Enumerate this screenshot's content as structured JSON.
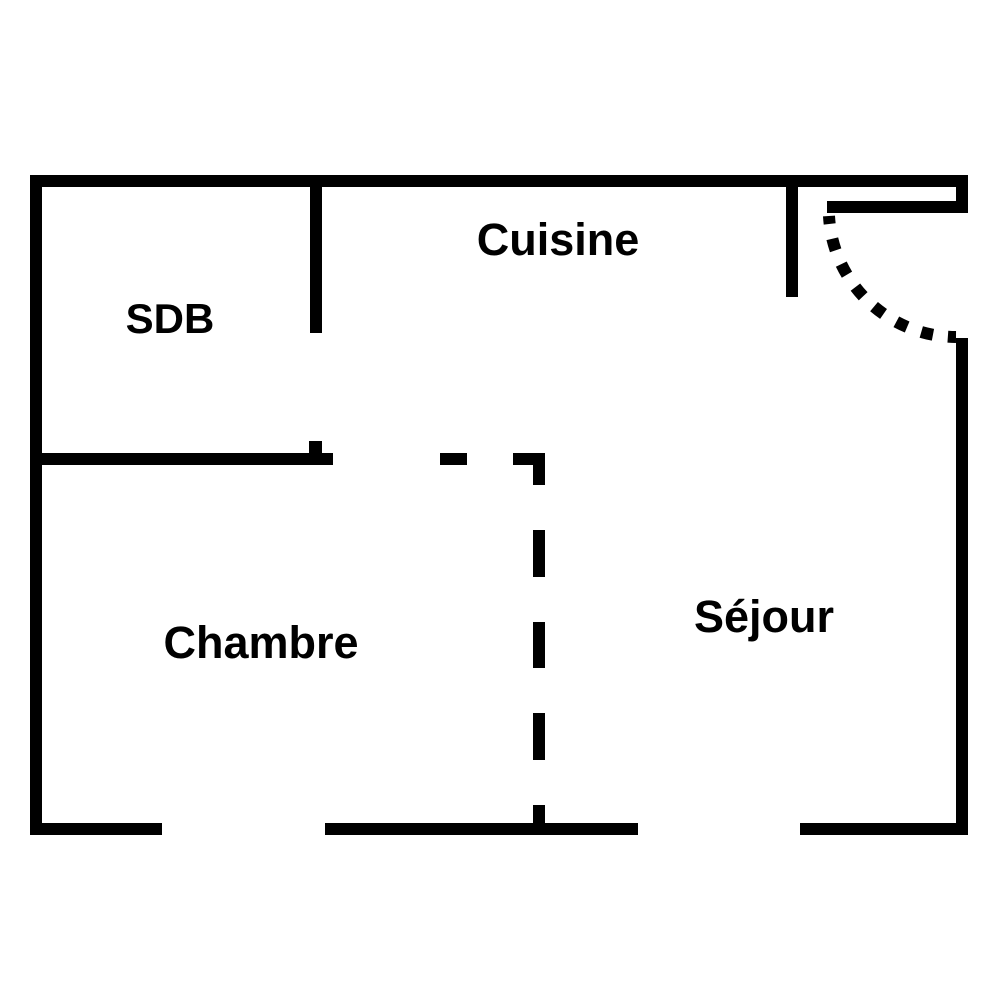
{
  "colors": {
    "walls": "#000000",
    "background": "#ffffff"
  },
  "floorplan": {
    "rooms": [
      {
        "id": "sdb",
        "label": "SDB"
      },
      {
        "id": "cuisine",
        "label": "Cuisine"
      },
      {
        "id": "chambre",
        "label": "Chambre"
      },
      {
        "id": "sejour",
        "label": "Séjour"
      }
    ],
    "features": [
      {
        "name": "entry-door-swing",
        "type": "dotted-arc"
      },
      {
        "name": "open-partition",
        "type": "dashed-line"
      },
      {
        "name": "door-openings",
        "type": "wall-gaps"
      }
    ]
  }
}
